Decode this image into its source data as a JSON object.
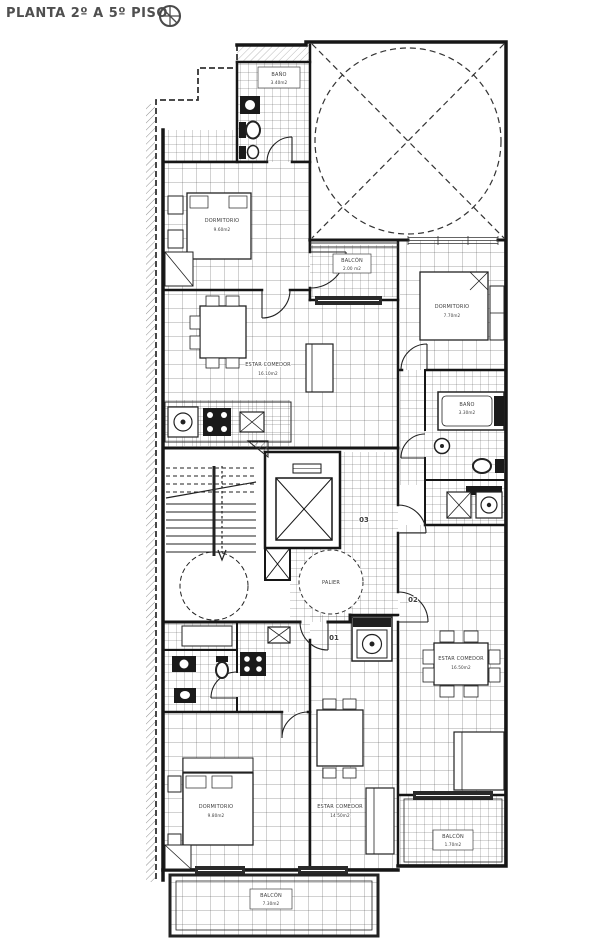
{
  "header": {
    "title": "PLANTA 2º A 5º PISO"
  },
  "rooms": {
    "bano1": {
      "name": "BAÑO",
      "area": "3.40m2"
    },
    "dorm1": {
      "name": "DORMITORIO",
      "area": "9.60m2"
    },
    "estar1": {
      "name": "ESTAR COMEDOR",
      "area": "16.10m2"
    },
    "balcon1": {
      "name": "BALCÓN",
      "area": "2.00 m2"
    },
    "dorm2": {
      "name": "DORMITORIO",
      "area": "7.70m2"
    },
    "bano2": {
      "name": "BAÑO",
      "area": "3.30m2"
    },
    "estar2": {
      "name": "ESTAR COMEDOR",
      "area": "16.50m2"
    },
    "balcon2": {
      "name": "BALCÓN",
      "area": "1.70m2"
    },
    "dorm3": {
      "name": "DORMITORIO",
      "area": "9.80m2"
    },
    "estar3": {
      "name": "ESTAR COMEDOR",
      "area": "14.50m2"
    },
    "balcon3": {
      "name": "BALCÓN",
      "area": "7.30m2"
    },
    "palier": {
      "name": "PALIER"
    }
  },
  "doors": {
    "d01": "01",
    "d02": "02",
    "d03": "03"
  },
  "colors": {
    "line": "#161616",
    "label": "#3d3d3d",
    "bg": "#ffffff"
  }
}
